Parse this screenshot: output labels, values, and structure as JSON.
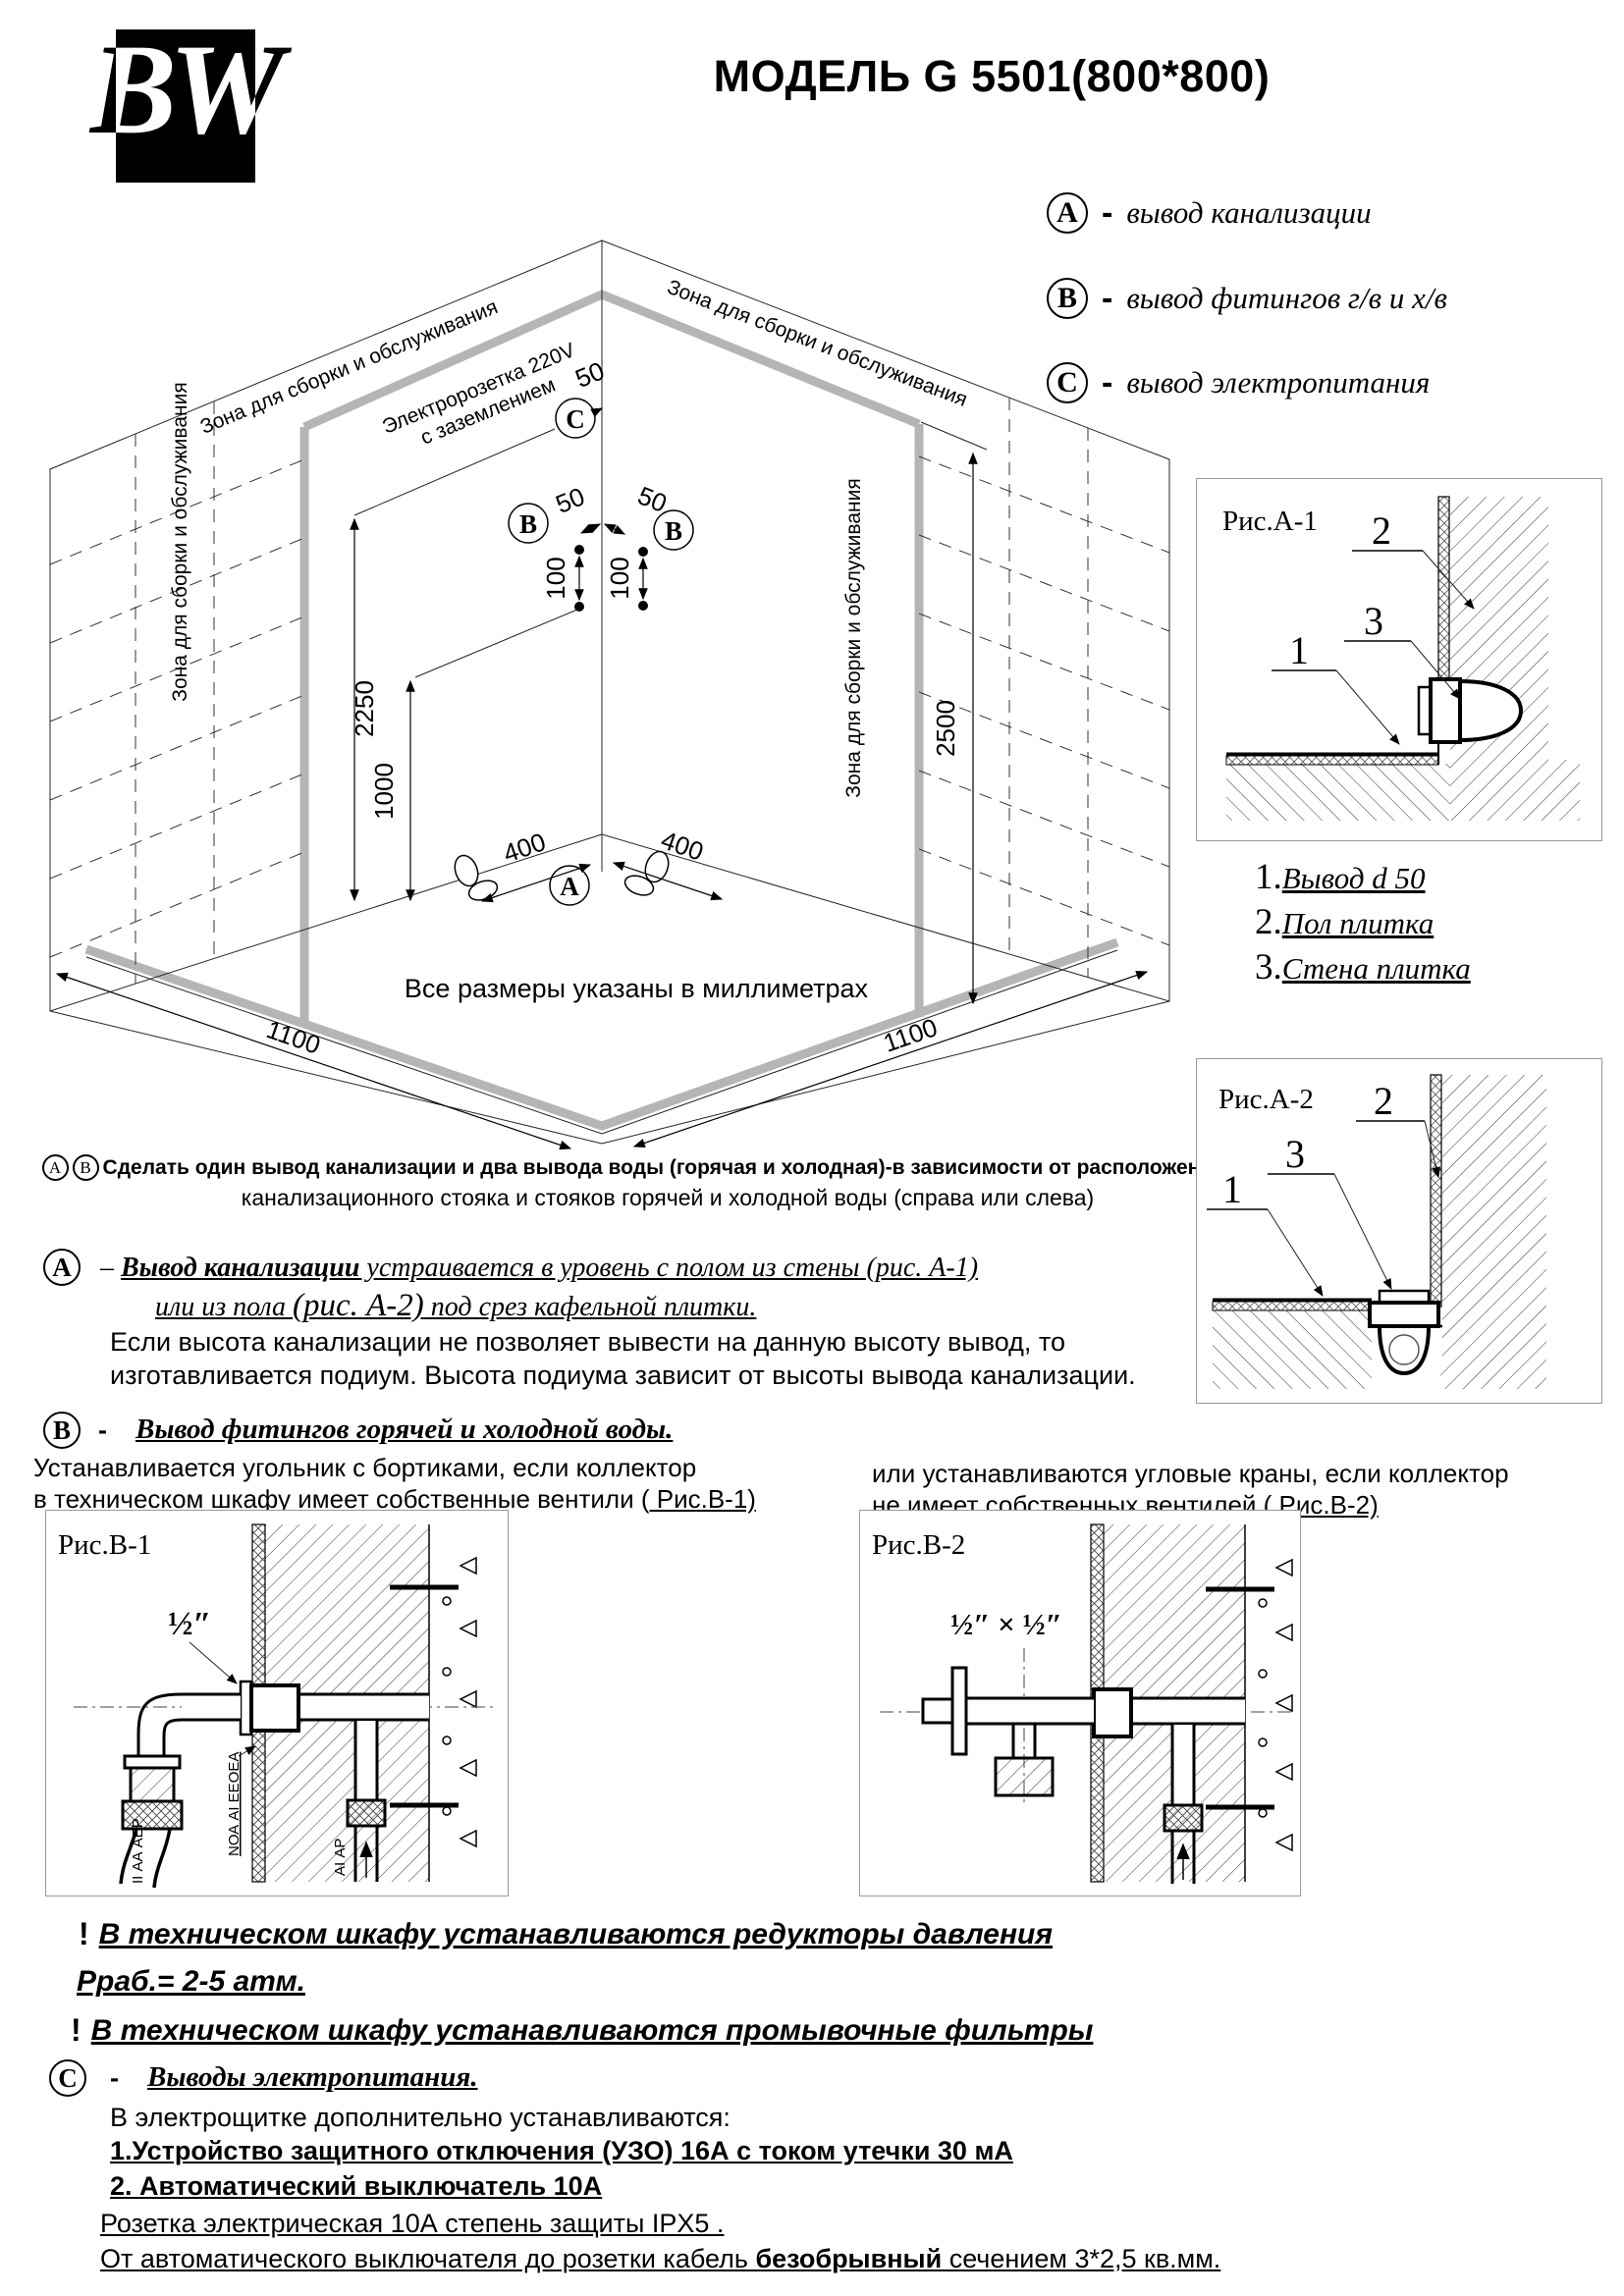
{
  "header": {
    "logo_text": "BW",
    "title": "МОДЕЛЬ G 5501(800*800)"
  },
  "legend": {
    "separator": "-",
    "items": [
      {
        "letter": "A",
        "text": "вывод канализации"
      },
      {
        "letter": "B",
        "text": "вывод фитингов г/в и х/в"
      },
      {
        "letter": "C",
        "text": "вывод электропитания"
      }
    ]
  },
  "diagram": {
    "zone_label": "Зона для сборки и обслуживания",
    "socket_line1": "Электророзетка 220V",
    "socket_line2": "с заземлением",
    "letter_a": "A",
    "letter_b": "B",
    "letter_c": "C",
    "dims": {
      "d50": "50",
      "d100": "100",
      "d400": "400",
      "d1000": "1000",
      "d1100": "1100",
      "d2250": "2250",
      "d2500": "2500"
    },
    "units_note": "Все размеры указаны в миллиметрах",
    "footnote": {
      "letter_a": "А",
      "letter_b": "В",
      "line1": "Сделать один вывод канализации и два вывода воды (горячая и холодная)-в зависимости от расположения жения",
      "line2": "канализационного стояка и стояков горячей и холодной воды (справа или слева)"
    }
  },
  "fig_a1": {
    "title": "Рис.А-1",
    "labels": [
      "3",
      "1",
      "2"
    ]
  },
  "fig_a2": {
    "title": "Рис.А-2",
    "labels": [
      "3",
      "1",
      "2"
    ]
  },
  "callout_list": {
    "items": [
      {
        "num": "1.",
        "text": "Вывод d 50"
      },
      {
        "num": "2.",
        "text": "Пол плитка"
      },
      {
        "num": "3.",
        "text": "Стена плитка"
      }
    ]
  },
  "section_a": {
    "letter": "A",
    "dash": "–",
    "heading_bold": "Вывод канализации",
    "heading_rest": " устраивается в уровень с полом из стены (рис. А-1)",
    "line2_pre": "или из пола ",
    "line2_fig": "(рис. А-2)",
    "line2_post": " под срез кафельной плитки.",
    "body1": "Если высота канализации не позволяет вывести на данную высоту вывод, то",
    "body2": "изготавливается подиум. Высота подиума зависит от высоты вывода канализации."
  },
  "section_b": {
    "letter": "B",
    "dash": "-",
    "heading": "Вывод фитингов горячей и холодной воды.",
    "left1": "Устанавливается угольник с бортиками,  если коллектор",
    "left2": "в техническом шкафу имеет собственные вентили (",
    "left_link": " Рис.В-1)",
    "right1": "или  устанавливаются угловые краны, если коллектор",
    "right2": "не имеет собственных вентилей (",
    "right_link": " Рис.В-2)"
  },
  "fig_b1": {
    "title": "Рис.В-1",
    "size_label": "½″",
    "rot1": "II АА АЕР",
    "rot2": "NОА АI ЕЕОЕА",
    "rot3": "АI АР"
  },
  "fig_b2": {
    "title": "Рис.В-2",
    "size_label": "½″ × ½″"
  },
  "warnings": {
    "bang": "!",
    "w1": "В техническом шкафу устанавливаются редукторы давления",
    "w1b": "Рраб.= 2-5 атм.",
    "w2": "В техническом шкафу устанавливаются промывочные фильтры"
  },
  "section_c": {
    "letter": "C",
    "dash": "-",
    "heading": "Выводы электропитания.",
    "intro": "В электрощитке дополнительно устанавливаются:",
    "item1": "1.Устройство защитного отключения (УЗО)  16А с током  утечки 30 мА",
    "item2": "2. Автоматический выключатель 10А",
    "line3": "Розетка электрическая 10А степень защиты IPX5 .",
    "line4_pre": "От автоматического выключателя до розетки кабель ",
    "line4_bold": "безобрывный",
    "line4_post": " сечением 3*2,5 кв.мм."
  }
}
